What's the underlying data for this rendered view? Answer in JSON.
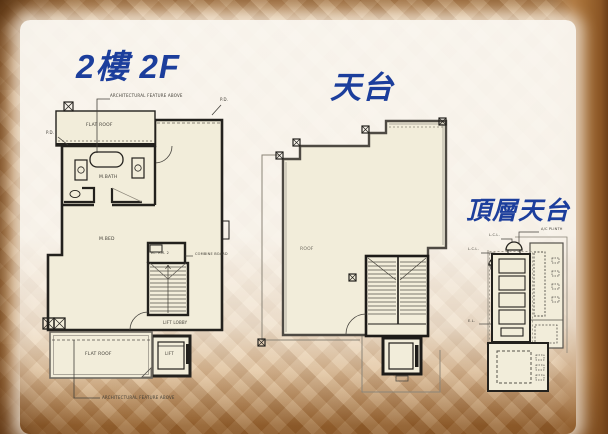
{
  "titles": {
    "floor2": "2樓 2F",
    "roof": "天台",
    "top_roof": "頂層天台"
  },
  "colors": {
    "title_blue": "#1c3e9c",
    "plan_fill": "#f2edda",
    "wall_ink": "#23211d",
    "wood_base": "#c89a66"
  },
  "plan_2f": {
    "labels": {
      "arch_feature_top": "ARCHITECTURAL FEATURE ABOVE",
      "flat_roof_top": "FLAT ROOF",
      "pd_right": "P.D.",
      "pd_left": "P.D.",
      "mbath": "M.BATH",
      "mbed": "M.BED",
      "el_rm": "EL. RM. 2",
      "combine_board": "COMBINE BOARD",
      "lift_lobby": "LIFT LOBBY",
      "lift": "LIFT",
      "flat_roof_bottom": "FLAT ROOF",
      "arch_feature_bottom": "ARCHITECTURAL FEATURE ABOVE"
    }
  },
  "plan_roof": {
    "labels": {
      "roof": "ROOF"
    }
  },
  "plan_top_roof": {
    "labels": {
      "ac_plinth": "A/C PLINTH",
      "lcl_upper": "L.C.L.",
      "lcl_lower": "L.C.L.",
      "el": "E.L."
    }
  }
}
